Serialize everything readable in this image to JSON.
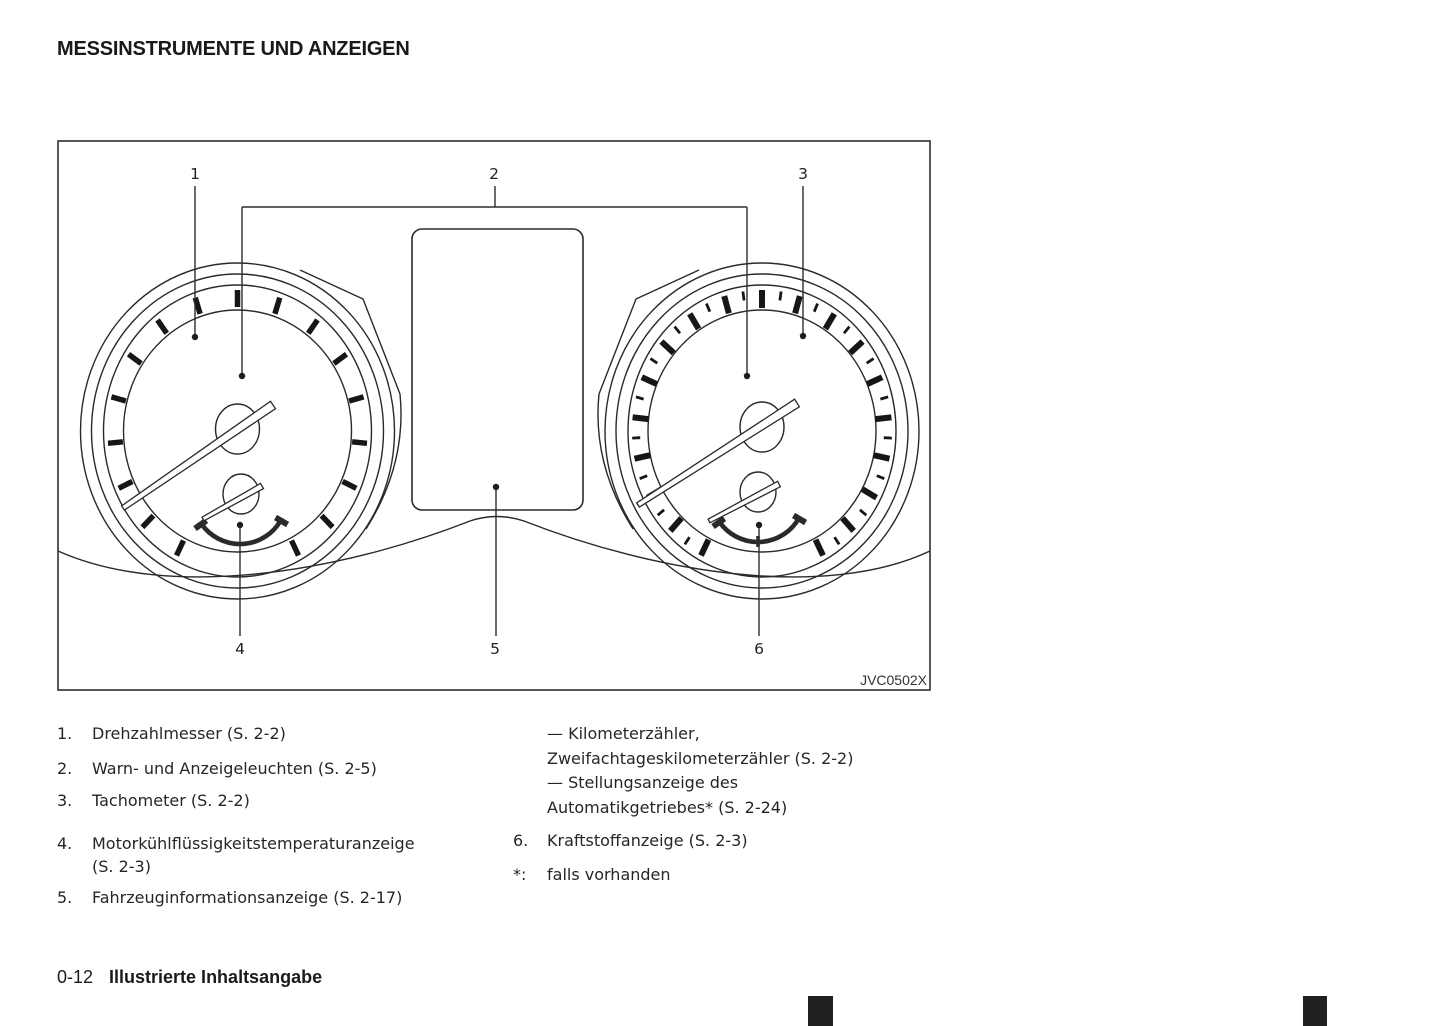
{
  "title": "MESSINSTRUMENTE UND ANZEIGEN",
  "figure": {
    "code": "JVC0502X",
    "callouts": [
      {
        "label": "1"
      },
      {
        "label": "2"
      },
      {
        "label": "3"
      },
      {
        "label": "4"
      },
      {
        "label": "5"
      },
      {
        "label": "6"
      }
    ]
  },
  "legend_left": [
    {
      "marker": "1.",
      "lines": [
        "Drehzahlmesser (S. 2-2)"
      ]
    },
    {
      "marker": "2.",
      "lines": [
        "Warn- und Anzeigeleuchten (S. 2-5)"
      ]
    },
    {
      "marker": "3.",
      "lines": [
        "Tachometer (S. 2-2)"
      ]
    },
    {
      "marker": "4.",
      "lines": [
        "Motorkühlflüssigkeitstemperaturanzeige",
        "(S. 2-3)"
      ]
    },
    {
      "marker": "5.",
      "lines": [
        "Fahrzeuginformationsanzeige (S. 2-17)"
      ]
    }
  ],
  "legend_right": [
    {
      "marker": "",
      "lines": [
        "— Kilometerzähler,",
        "Zweifachtageskilometerzähler (S. 2-2)",
        "— Stellungsanzeige des",
        "Automatikgetriebes* (S. 2-24)"
      ]
    },
    {
      "marker": "6.",
      "lines": [
        "Kraftstoffanzeige (S. 2-3)"
      ]
    },
    {
      "marker": "*:",
      "lines": [
        "falls vorhanden"
      ]
    }
  ],
  "footer": {
    "page_number": "0-12",
    "section_title": "Illustrierte Inhaltsangabe"
  }
}
